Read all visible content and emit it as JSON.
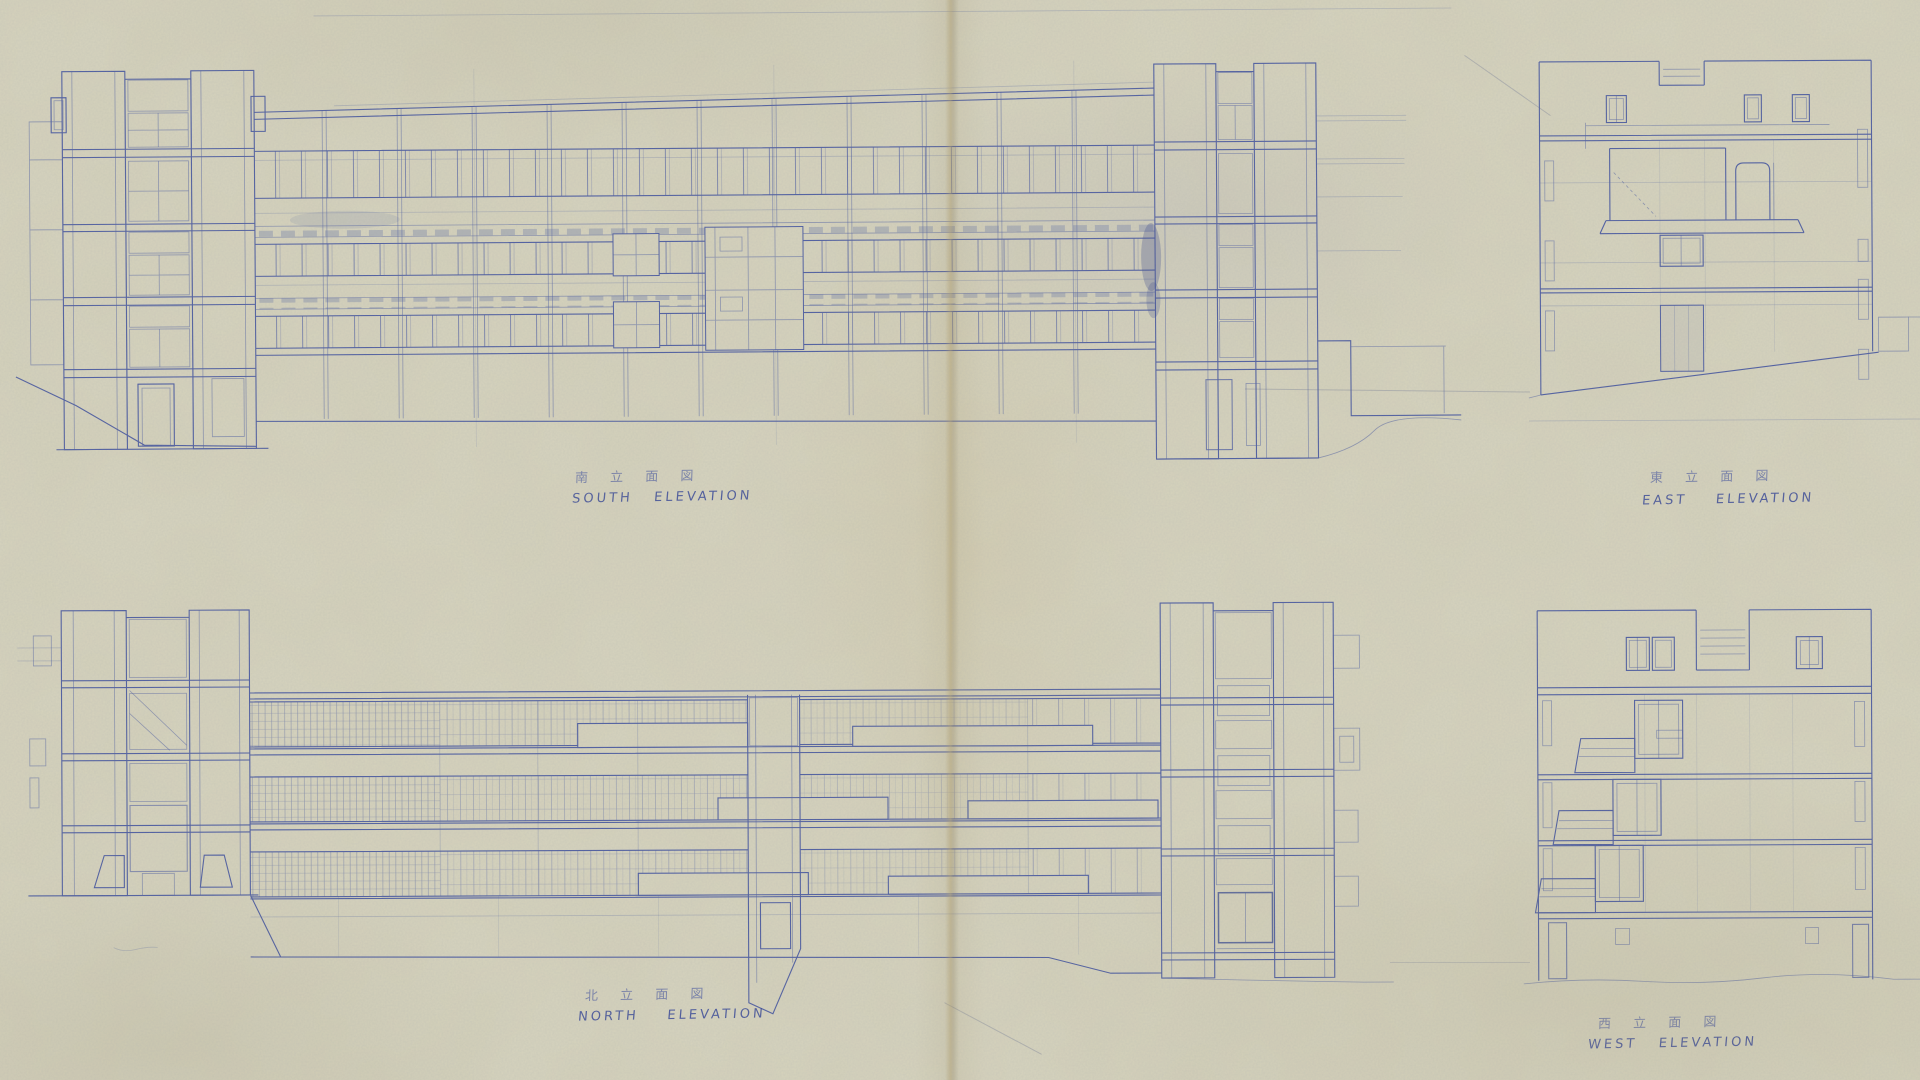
{
  "document": {
    "kind": "scanned architectural blueprint sheet",
    "paper_color": "#d7d4be",
    "ink_color": "#4c5ca2",
    "dark_ink_color": "#35458c",
    "crease_color": "#b09c68"
  },
  "elevations": [
    {
      "id": "south",
      "label_ja": "南 立 面 図",
      "label_en": "SOUTH   ELEVATION"
    },
    {
      "id": "east",
      "label_ja": "東 立 面 図",
      "label_en": "EAST    ELEVATION"
    },
    {
      "id": "north",
      "label_ja": "北 立 面 図",
      "label_en": "NORTH    ELEVATION"
    },
    {
      "id": "west",
      "label_ja": "西 立 面 図",
      "label_en": "WEST   ELEVATION"
    }
  ]
}
